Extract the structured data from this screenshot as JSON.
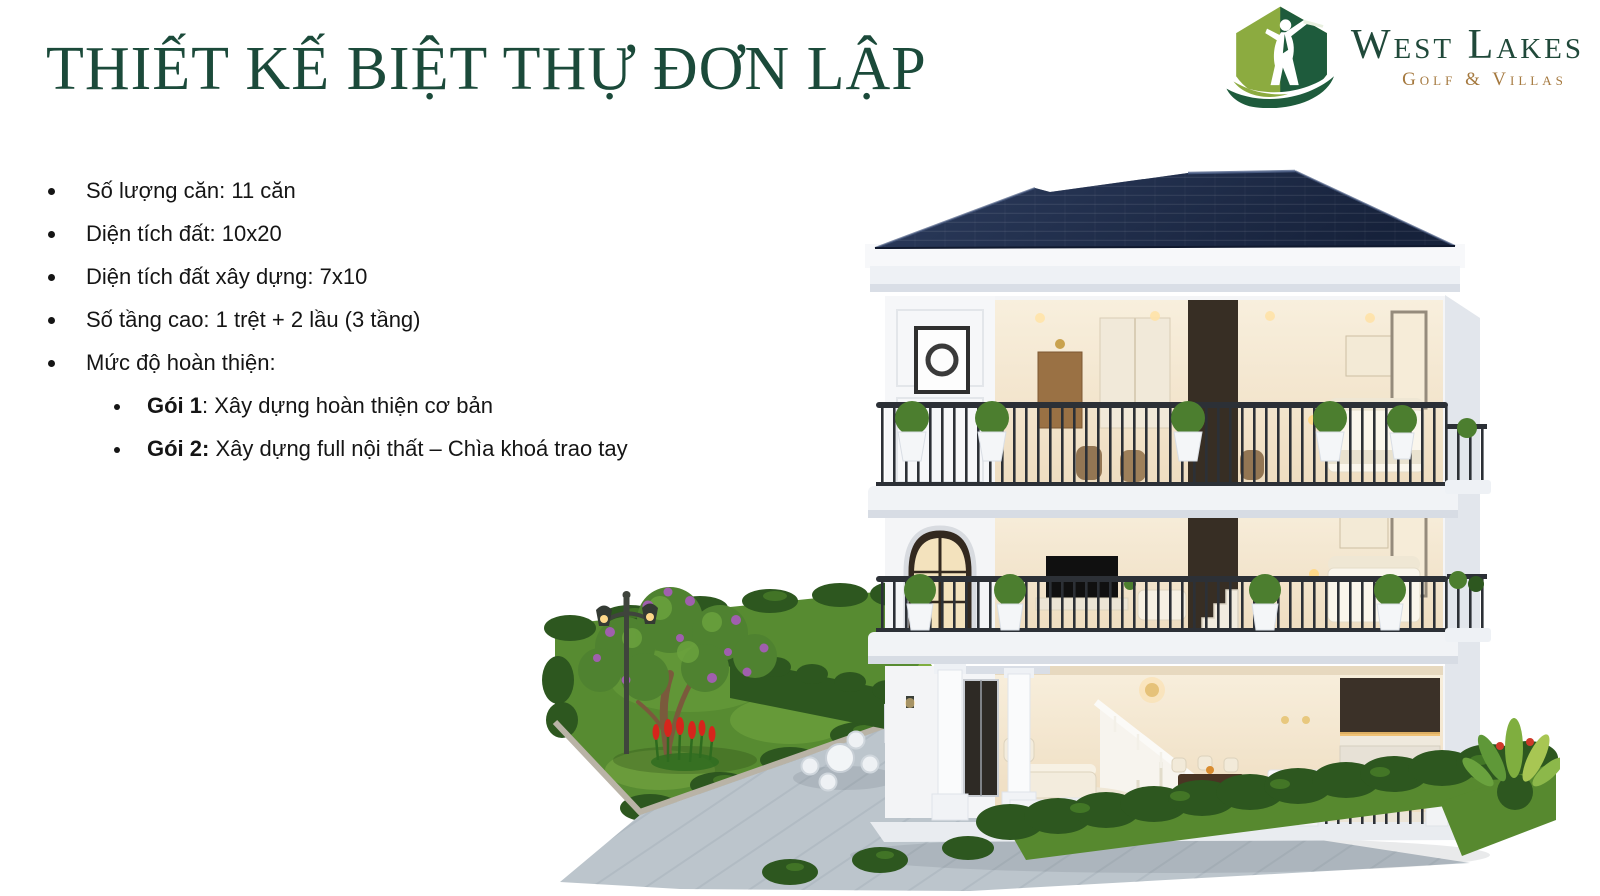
{
  "slide": {
    "background": "#ffffff"
  },
  "header": {
    "title": "THIẾT KẾ BIỆT THỰ ĐƠN LẬP",
    "title_color": "#1b4a3a"
  },
  "logo": {
    "name": "West Lakes Golf & Villas",
    "line1": "West Lakes",
    "line2": "Golf & Villas",
    "line1_color": "#20493a",
    "line2_color": "#a5793f",
    "mark_icon": "golfer-swing-icon",
    "mark_light_green": "#8cab40",
    "mark_dark_green": "#1e5b3c"
  },
  "specs": {
    "bullets": [
      "Số lượng căn: 11 căn",
      "Diện tích đất: 10x20",
      "Diện tích đất xây dựng: 7x10",
      "Số tầng cao: 1 trệt + 2 lầu (3 tầng)",
      "Mức độ hoàn thiện:"
    ],
    "sub_bullets": [
      {
        "label": "Gói 1",
        "text": ": Xây dựng hoàn thiện cơ bản"
      },
      {
        "label": "Gói 2:",
        "text": " Xây dựng full nội thất – Chìa khoá trao tay"
      }
    ]
  },
  "illustration": {
    "alt": "3D cutaway rendering of a 3-storey detached villa with landscaped garden, lawn, tree, lamp post and patio set",
    "roof_color": "#1e2b48",
    "wall_color": "#f4f5f7",
    "interior_warm": "#f5e9d2",
    "railing_color": "#2c3036",
    "lawn_color": "#578b31",
    "hedge_color": "#2d571f",
    "bush_green": "#4c7e2f",
    "paving_color": "#bcc5cc",
    "blossom_color": "#a05fae",
    "flower_red": "#d6251c"
  }
}
